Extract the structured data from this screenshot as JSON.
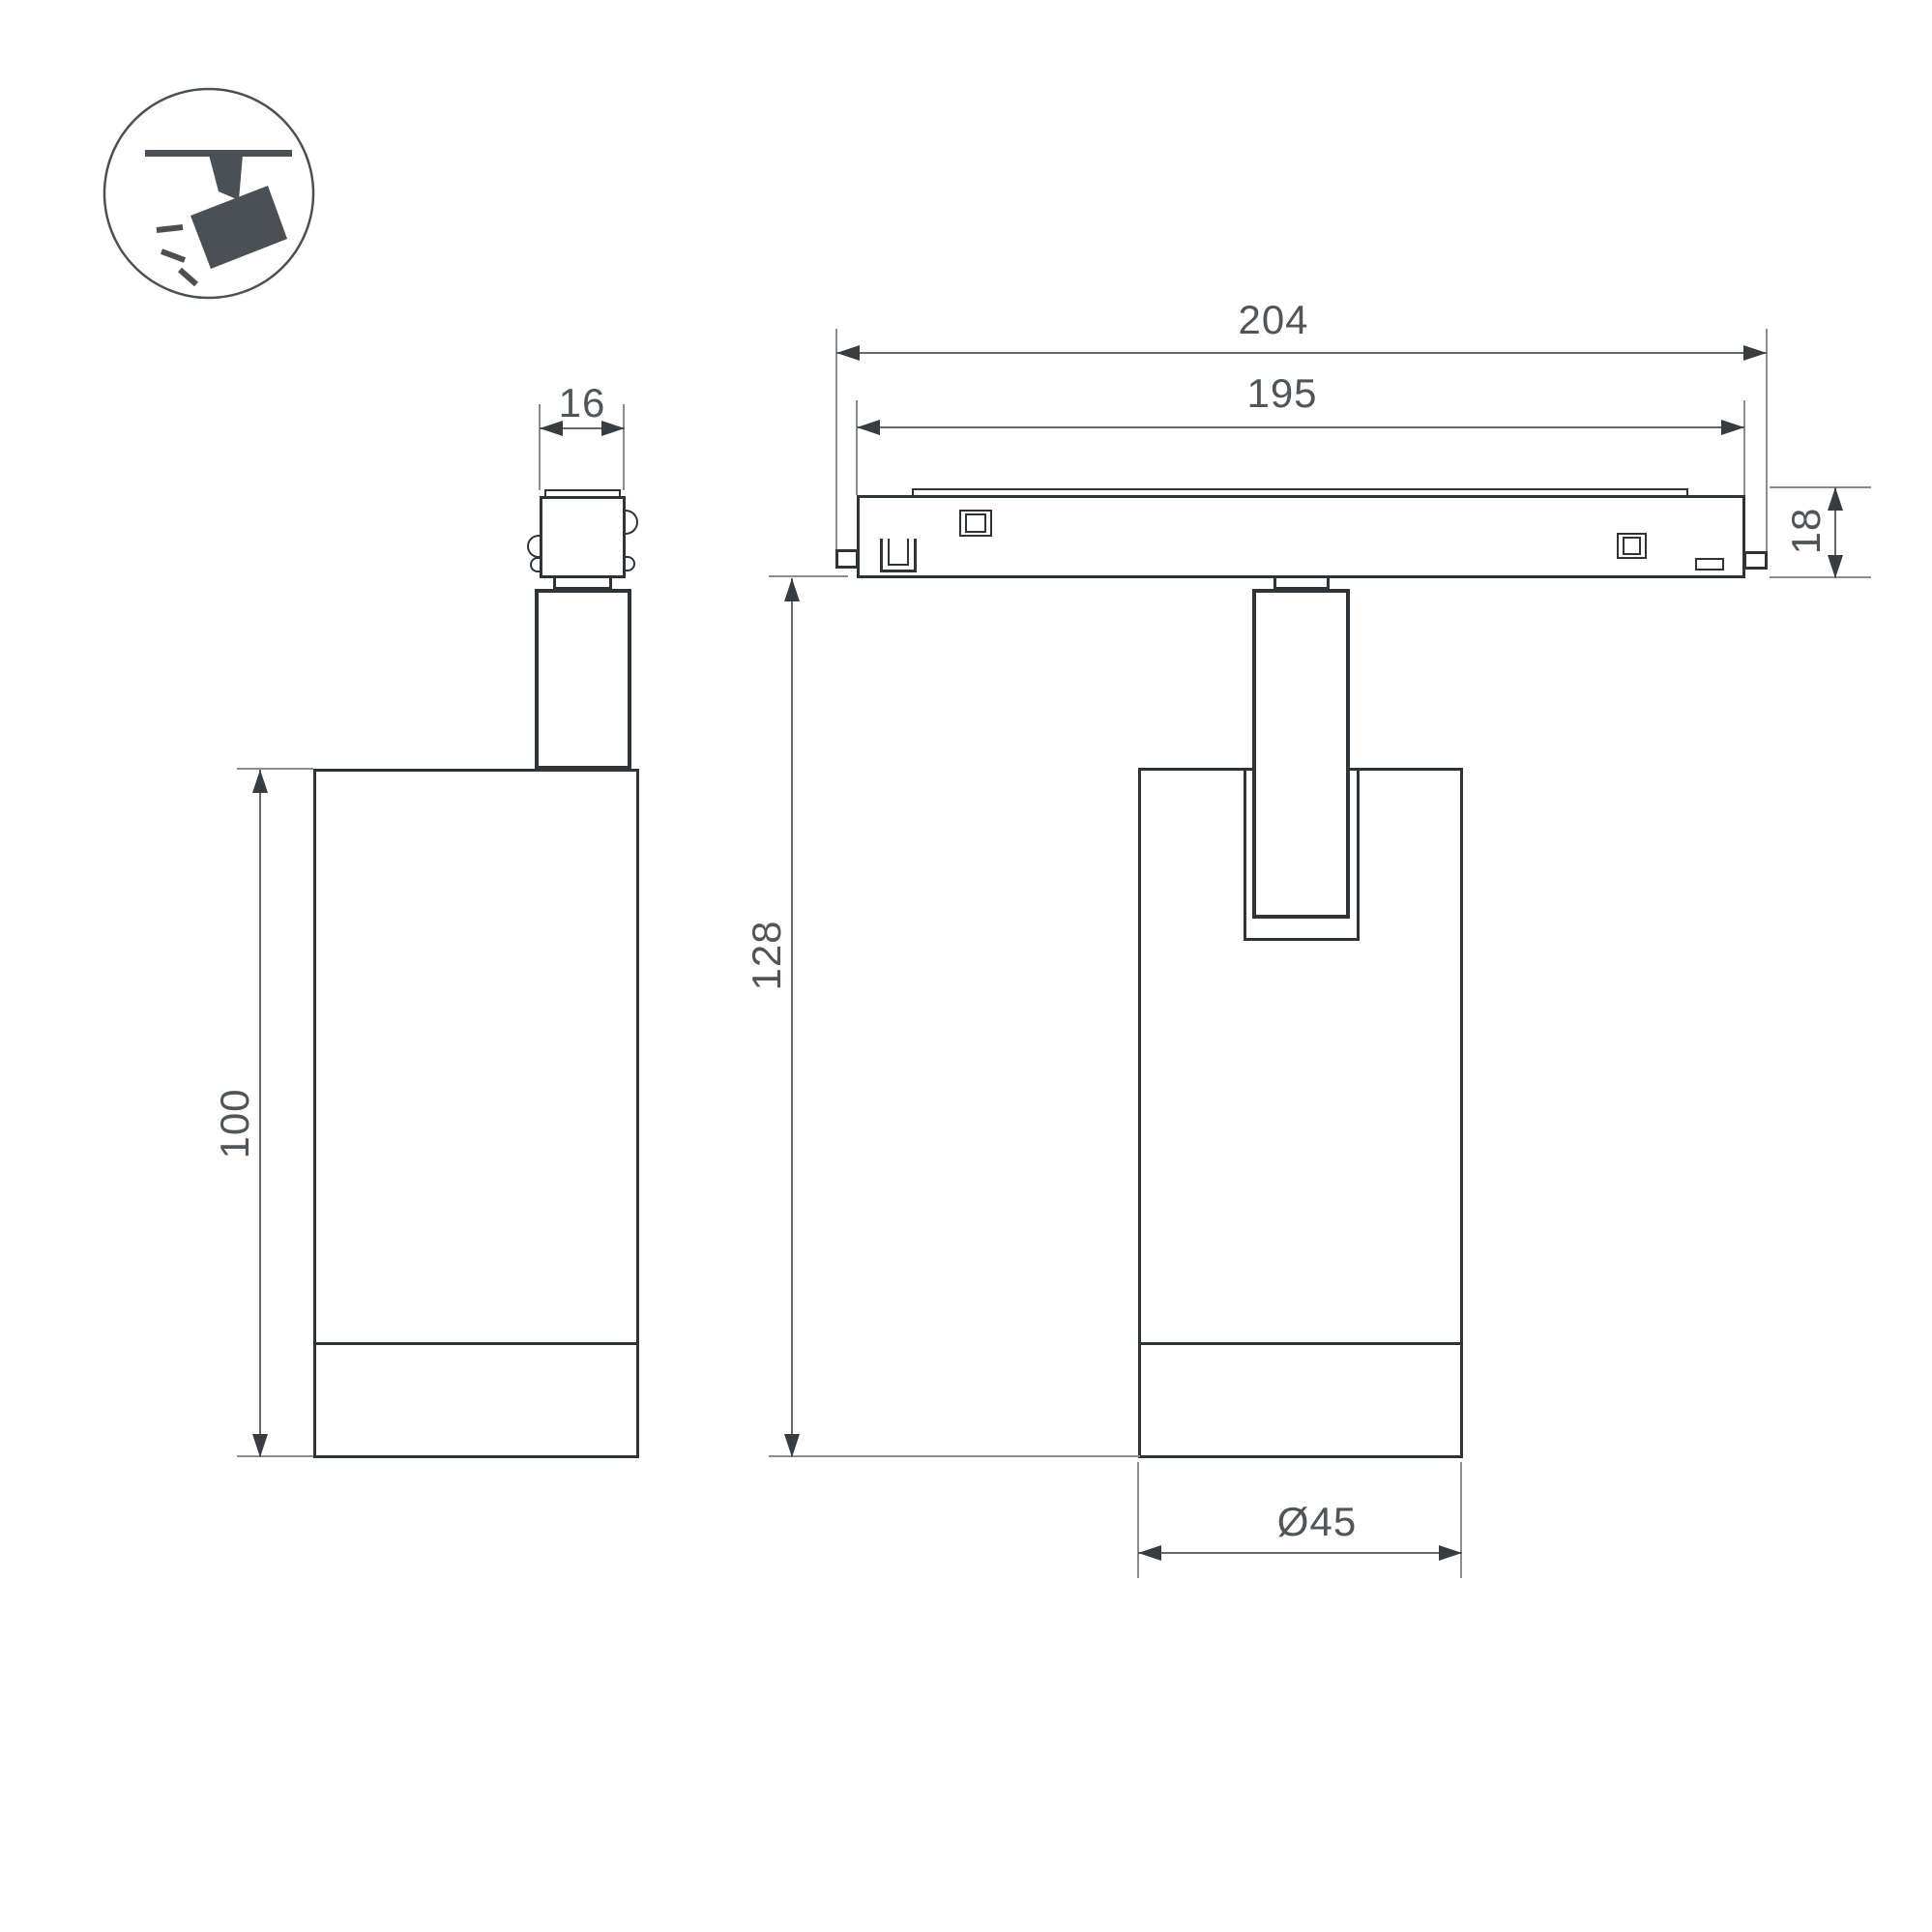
{
  "drawing": {
    "icon": "ceiling-track-spotlight-icon",
    "labels": {
      "overall_width": "204",
      "inner_width": "195",
      "adapter_width": "16",
      "track_height": "18",
      "total_height": "128",
      "body_height": "100",
      "diameter": "Ø45"
    },
    "colors": {
      "outline": "#2f3439",
      "dimension_line": "#64686c",
      "arrow": "#383d41",
      "text": "#50555a",
      "icon": "#4a5056",
      "background": "#ffffff"
    }
  }
}
